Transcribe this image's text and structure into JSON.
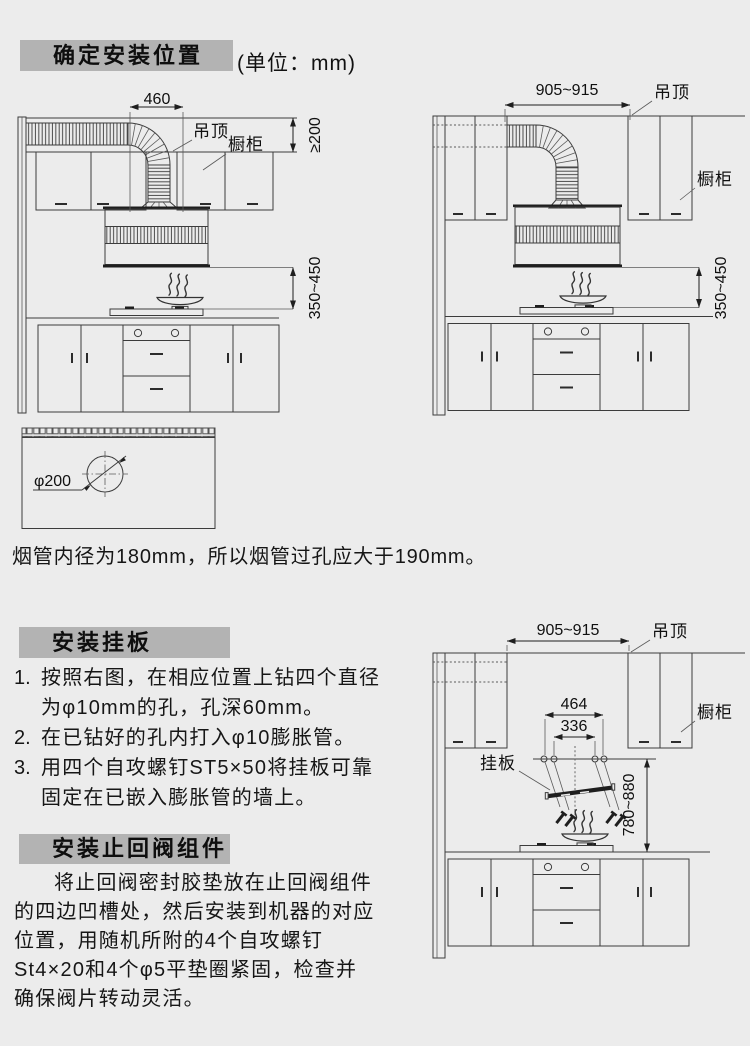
{
  "palette": {
    "page-bg": "#ececec",
    "header-bg": "#b3b3b3",
    "ink": "#141414",
    "line": "#3c3c3c"
  },
  "sections": {
    "s1": {
      "title": "确定安装位置",
      "unit": "(单位：mm)"
    },
    "s2": {
      "title": "安装挂板",
      "steps": [
        {
          "num": "1.",
          "lines": [
            "按照右图，在相应位置上钻四个直径",
            "为φ10mm的孔，孔深60mm。"
          ]
        },
        {
          "num": "2.",
          "lines": [
            "在已钻好的孔内打入φ10膨胀管。"
          ]
        },
        {
          "num": "3.",
          "lines": [
            "用四个自攻螺钉ST5×50将挂板可靠",
            "固定在已嵌入膨胀管的墙上。"
          ]
        }
      ]
    },
    "s3": {
      "title": "安装止回阀组件",
      "lines": [
        "将止回阀密封胶垫放在止回阀组件",
        "的四边凹槽处，然后安装到机器的对应",
        "位置，用随机所附的4个自攻螺钉",
        "St4×20和4个φ5平垫圈紧固，检查并",
        "确保阀片转动灵活。"
      ]
    }
  },
  "hole_note": "烟管内径为180mm，所以烟管过孔应大于190mm。",
  "diagrams": {
    "left": {
      "width": "460",
      "ceiling": "吊顶",
      "cabinet": "橱柜",
      "gap": "≥200",
      "height": "350~450"
    },
    "right_top": {
      "width": "905~915",
      "ceiling": "吊顶",
      "cabinet": "橱柜",
      "height": "350~450"
    },
    "hole": {
      "dia": "φ200"
    },
    "right_bottom": {
      "width": "905~915",
      "ceiling": "吊顶",
      "cabinet": "橱柜",
      "outer": "464",
      "inner": "336",
      "plate": "挂板",
      "height": "780~880"
    }
  }
}
